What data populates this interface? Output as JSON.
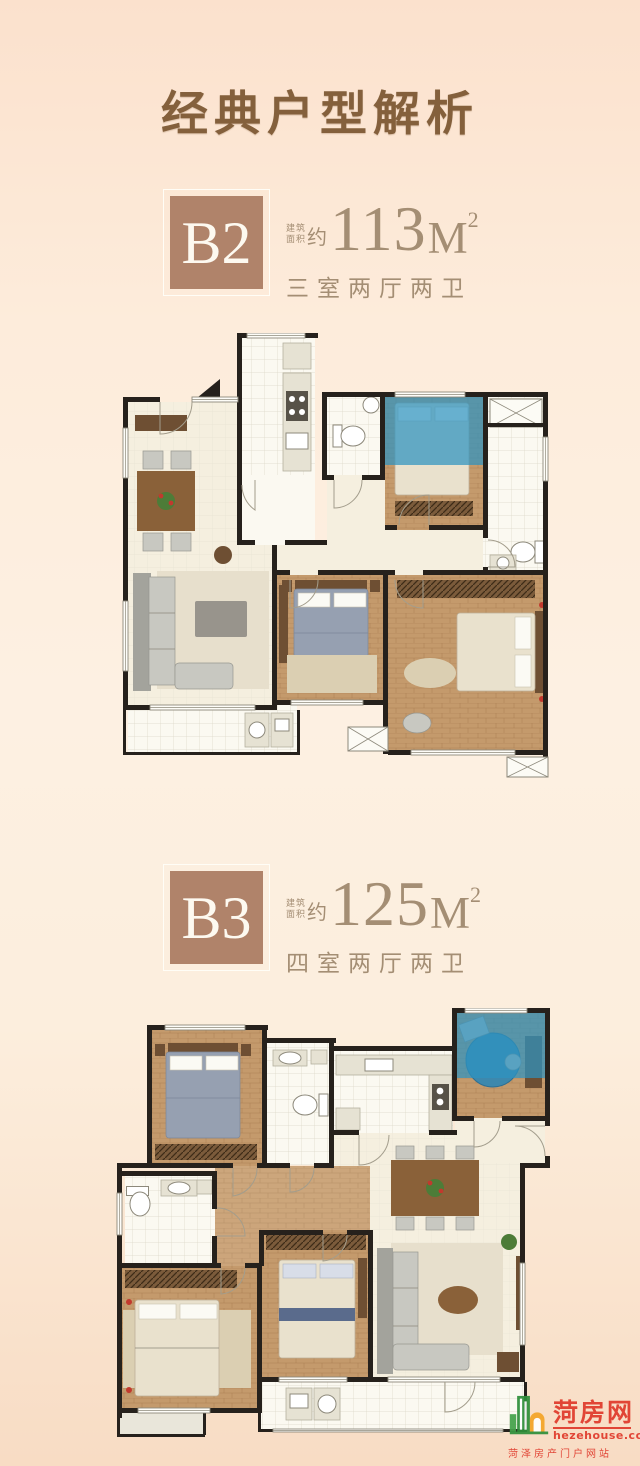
{
  "page": {
    "title": "经典户型解析"
  },
  "units": [
    {
      "code": "B2",
      "area_label_line1": "建筑",
      "area_label_line2": "面积",
      "area_approx": "约",
      "area_value": "113",
      "area_unit": "M",
      "area_sup": "2",
      "rooms": "三室两厅两卫"
    },
    {
      "code": "B3",
      "area_label_line1": "建筑",
      "area_label_line2": "面积",
      "area_approx": "约",
      "area_value": "125",
      "area_unit": "M",
      "area_sup": "2",
      "rooms": "四室两厅两卫"
    }
  ],
  "watermark": {
    "site_name": "菏房网",
    "site_url": "hezehouse.com",
    "tagline": "菏泽房产门户网站"
  },
  "colors": {
    "background_top": "#fbe1cd",
    "background_mid": "#fdf0e2",
    "background_bottom": "#f8dcc4",
    "title_brown": "#84603c",
    "unit_box_brown": "#b0836a",
    "unit_text_tan": "#a48e74",
    "plan_wall": "#26211c",
    "plan_wood": "#c49a6c",
    "plan_blue": "#2e93c0",
    "logo_red": "#e03a2c",
    "logo_green": "#2f8f3b",
    "logo_orange": "#f4a427"
  }
}
